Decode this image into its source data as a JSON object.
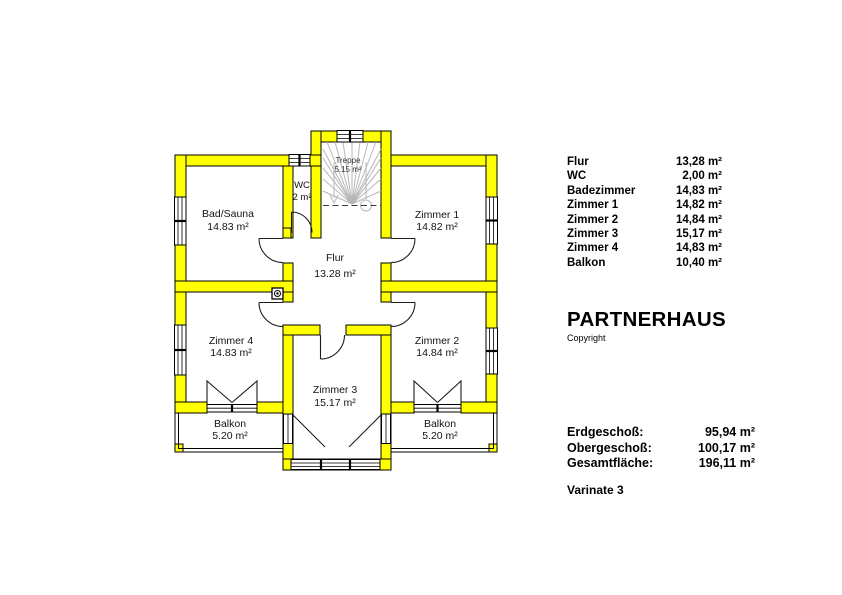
{
  "title": "PARTNERHAUS",
  "copyright": "Copyright",
  "variant": "Varinate 3",
  "colors": {
    "wall": "#ffff00"
  },
  "legend": {
    "rows": [
      {
        "label": "Flur",
        "value": "13,28 m²"
      },
      {
        "label": "WC",
        "value": "2,00 m²"
      },
      {
        "label": "Badezimmer",
        "value": "14,83 m²"
      },
      {
        "label": "Zimmer 1",
        "value": "14,82 m²"
      },
      {
        "label": "Zimmer 2",
        "value": "14,84 m²"
      },
      {
        "label": "Zimmer 3",
        "value": "15,17 m²"
      },
      {
        "label": "Zimmer 4",
        "value": "14,83 m²"
      },
      {
        "label": "Balkon",
        "value": "10,40 m²"
      }
    ]
  },
  "summary": {
    "rows": [
      {
        "label": "Erdgeschoß:",
        "value": "95,94 m²"
      },
      {
        "label": "Obergeschoß:",
        "value": "100,17 m²"
      },
      {
        "label": "Gesamtfläche:",
        "value": "196,11 m²"
      }
    ]
  },
  "plan": {
    "rooms": {
      "treppe": {
        "name": "Treppe",
        "area": "5.15 m²"
      },
      "wc": {
        "name": "WC",
        "area": "2 m²"
      },
      "bad_sauna": {
        "name": "Bad/Sauna",
        "area": "14.83 m²"
      },
      "zimmer1": {
        "name": "Zimmer 1",
        "area": "14.82 m²"
      },
      "flur": {
        "name": "Flur",
        "area": "13.28 m²"
      },
      "zimmer4": {
        "name": "Zimmer 4",
        "area": "14.83 m²"
      },
      "zimmer2": {
        "name": "Zimmer 2",
        "area": "14.84 m²"
      },
      "zimmer3": {
        "name": "Zimmer 3",
        "area": "15.17 m²"
      },
      "balkon_left": {
        "name": "Balkon",
        "area": "5.20 m²"
      },
      "balkon_right": {
        "name": "Balkon",
        "area": "5.20 m²"
      }
    }
  }
}
